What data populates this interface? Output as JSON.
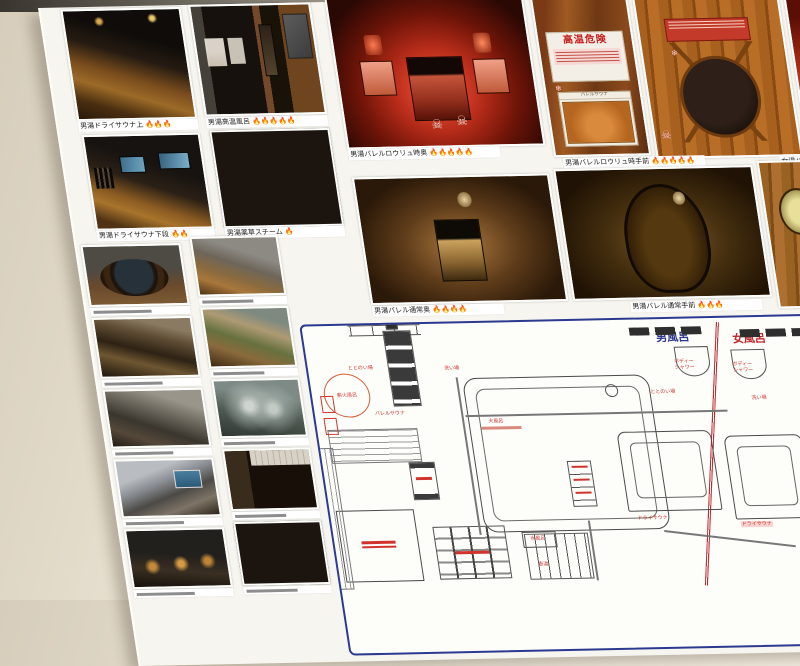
{
  "captions": {
    "g1": "男湯ドライサウナ上 🔥🔥🔥",
    "g2": "男湯高温風呂 🔥🔥🔥🔥🔥",
    "g3": "男湯ドライサウナ下段 🔥🔥",
    "g4": "男湯薬草スチーム 🔥",
    "b1": "男湯バレルロウリュ時奥 🔥🔥🔥🔥🔥",
    "b2": "男湯バレルロウリュ時手前 🔥🔥🔥🔥🔥",
    "b3": "女湯バレルロウリュ時",
    "c1": "男湯バレル通常奥 🔥🔥🔥🔥",
    "c2": "男湯バレル通常手前 🔥🔥🔥",
    "c3": "女湯バレル通常奥 🔥"
  },
  "sign": {
    "title": "高温危険",
    "card_header": "バレルサウナ"
  },
  "doodles": {
    "skull": "☠",
    "snowflake": "❄"
  },
  "floor_plan": {
    "mens_title": "男風呂",
    "womens_title": "女風呂",
    "labels": {
      "makibi_buro": "薪火風呂",
      "barrel_sauna": "バレルサウナ",
      "totonoi_left": "ととのい場",
      "araiba_left": "洗い場",
      "ofuro": "大風呂",
      "mizuburo": "水風呂",
      "tsuboyu": "壺湯",
      "dry_sauna_left": "ドライサウナ",
      "dry_sauna_right": "ドライサウナ",
      "body_shower_left": "ボディー\nシャワー",
      "body_shower_right": "ボディー\nシャワー",
      "totonoi_right": "ととのい場",
      "araiba_right": "洗い場"
    },
    "colors": {
      "border": "#2b3990",
      "divider": "#c1272d",
      "label": "#d0342c"
    }
  }
}
